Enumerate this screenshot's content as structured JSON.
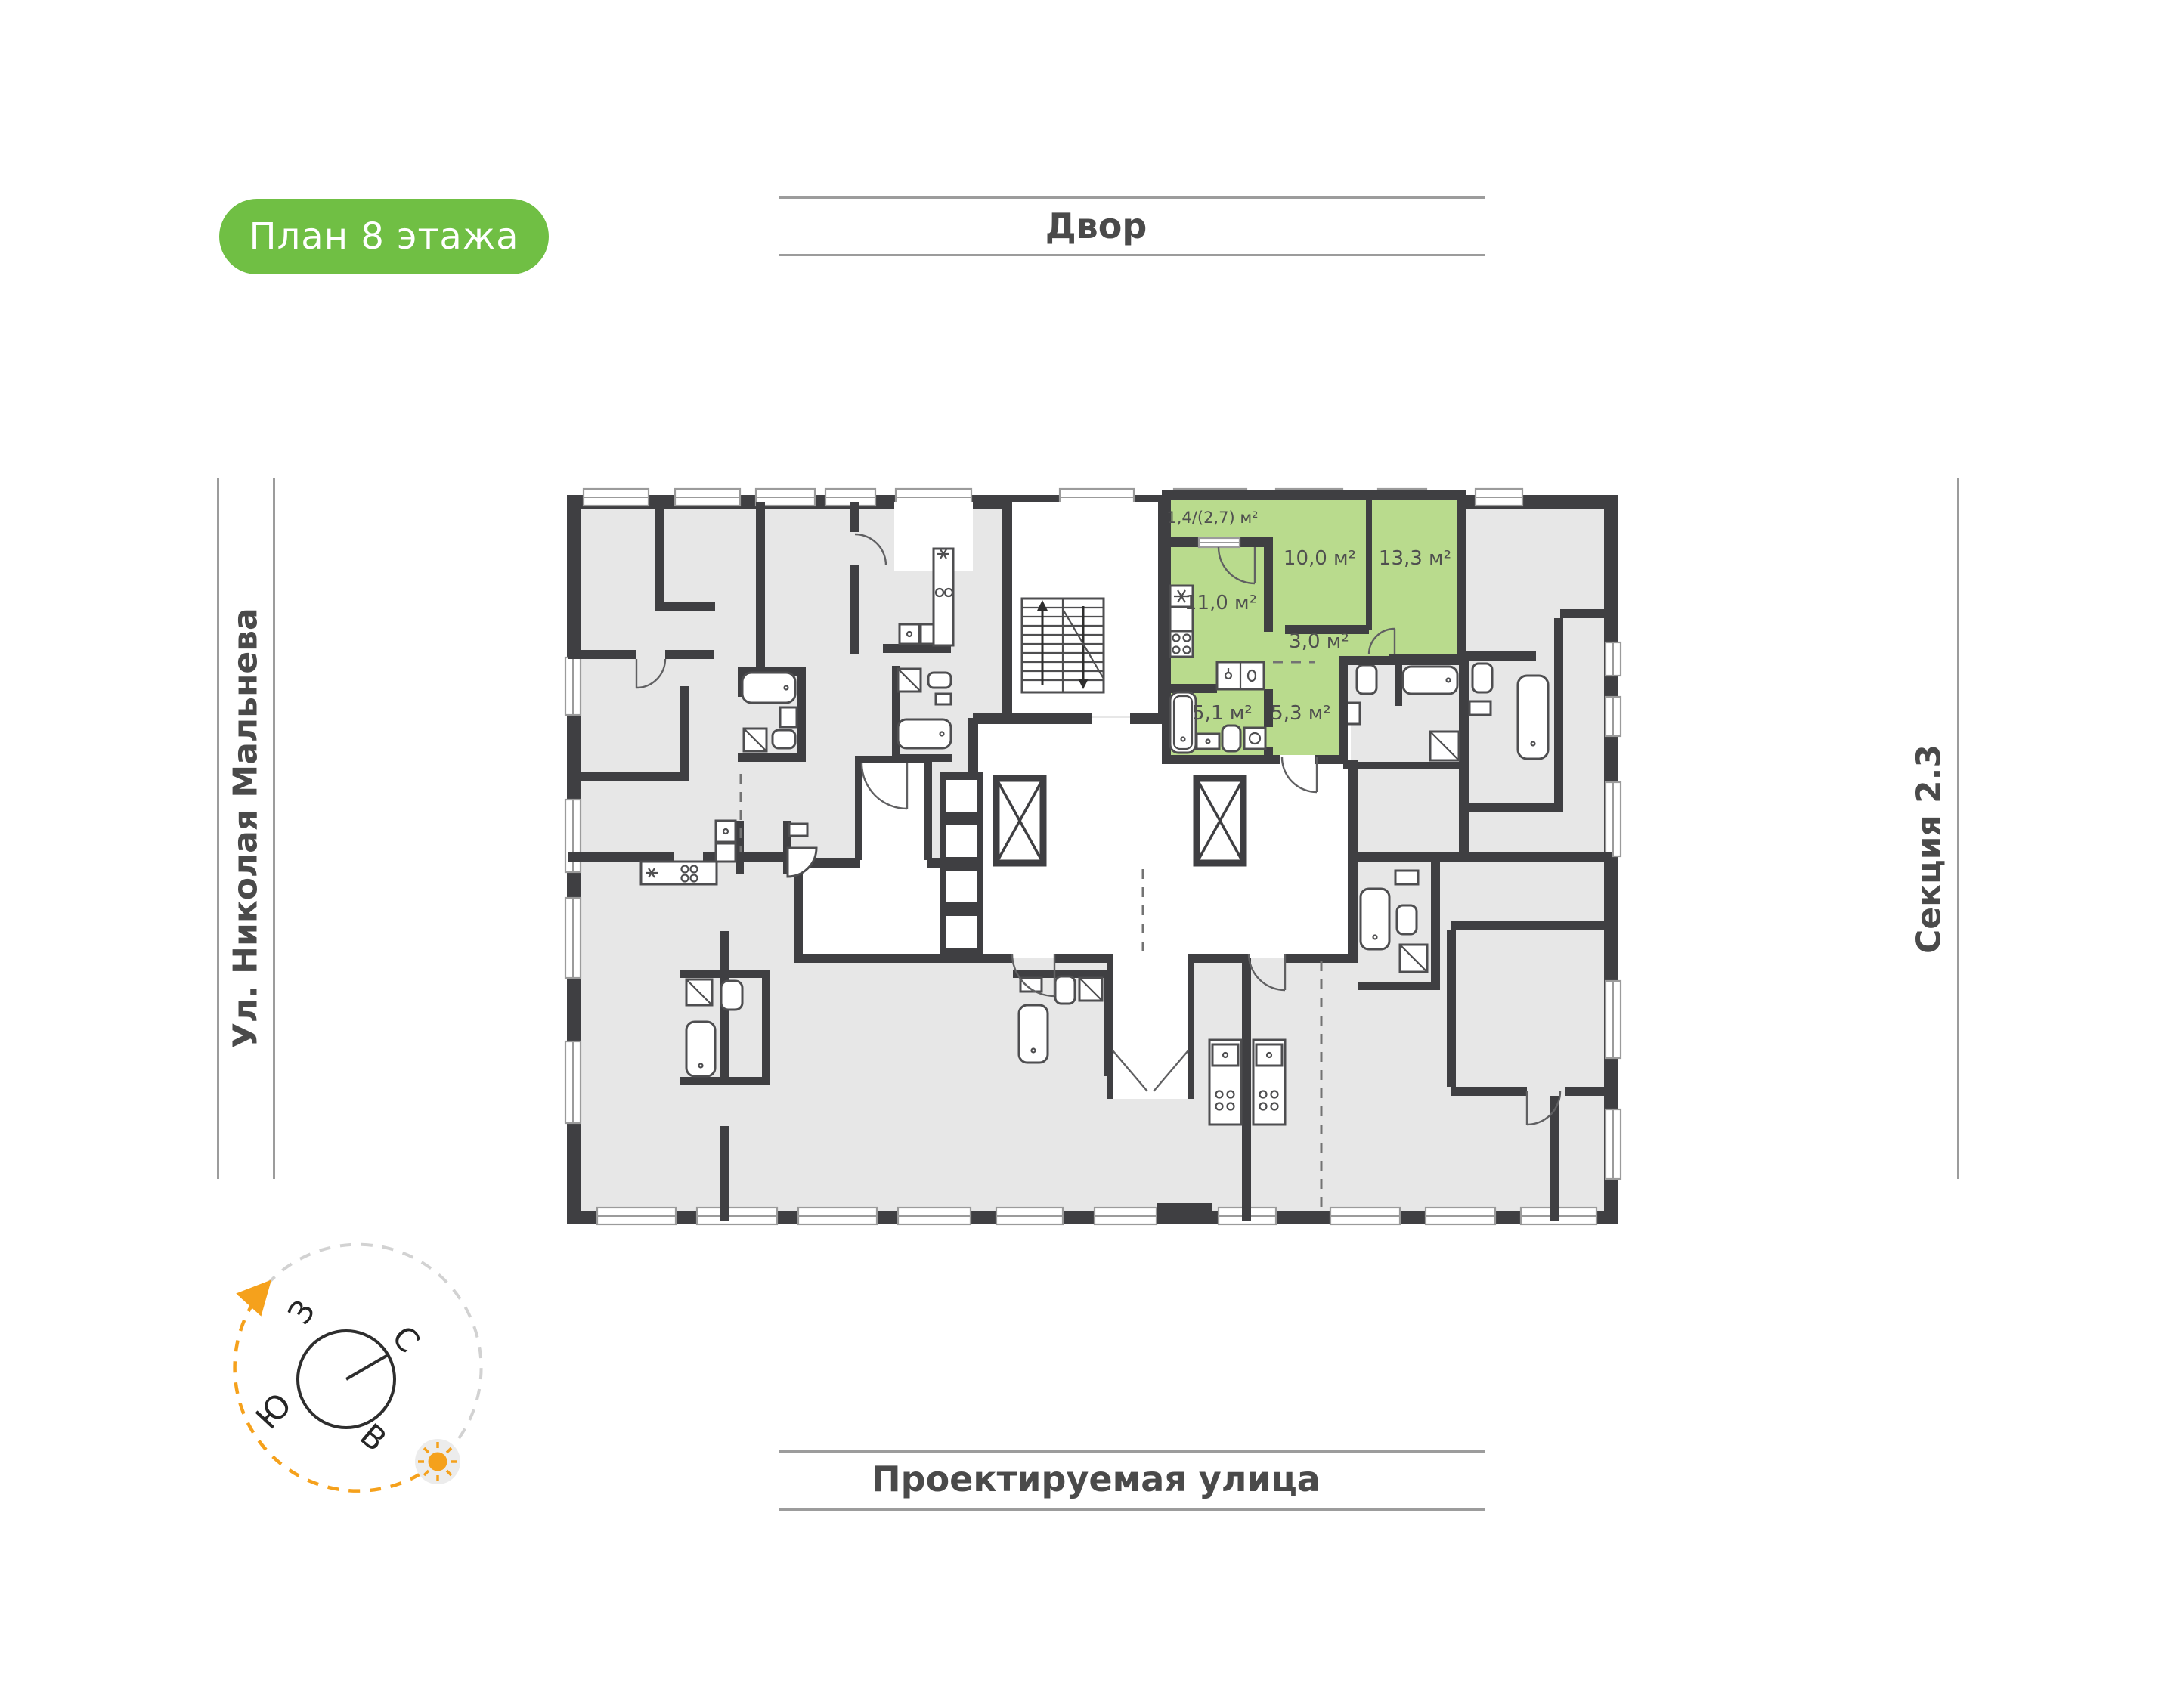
{
  "badge": {
    "label": "План 8 этажа",
    "bg": "#70bf44",
    "text_color": "#ffffff"
  },
  "surroundings": {
    "top": "Двор",
    "bottom": "Проектируемая улица",
    "left": "Ул. Николая Мальнева",
    "right": "Секция 2.3"
  },
  "compass": {
    "west": "З",
    "north": "С",
    "south": "Ю",
    "east": "В",
    "accent": "#f5a11c"
  },
  "apartment": {
    "highlight_color": "#b9db8d",
    "rooms": [
      {
        "id": "balcony",
        "area": "1,4/(2,7) м²"
      },
      {
        "id": "room-10",
        "area": "10,0 м²"
      },
      {
        "id": "room-13",
        "area": "13,3 м²"
      },
      {
        "id": "kitchen-living",
        "area": "11,0 м²"
      },
      {
        "id": "hallway",
        "area": "3,0 м²"
      },
      {
        "id": "bathroom",
        "area": "5,1 м²"
      },
      {
        "id": "hall",
        "area": "5,3 м²"
      }
    ]
  },
  "colors": {
    "walls": "#3f3f42",
    "apartment_fill": "#e7e7e7",
    "grey_rule": "#9c9c9c"
  }
}
